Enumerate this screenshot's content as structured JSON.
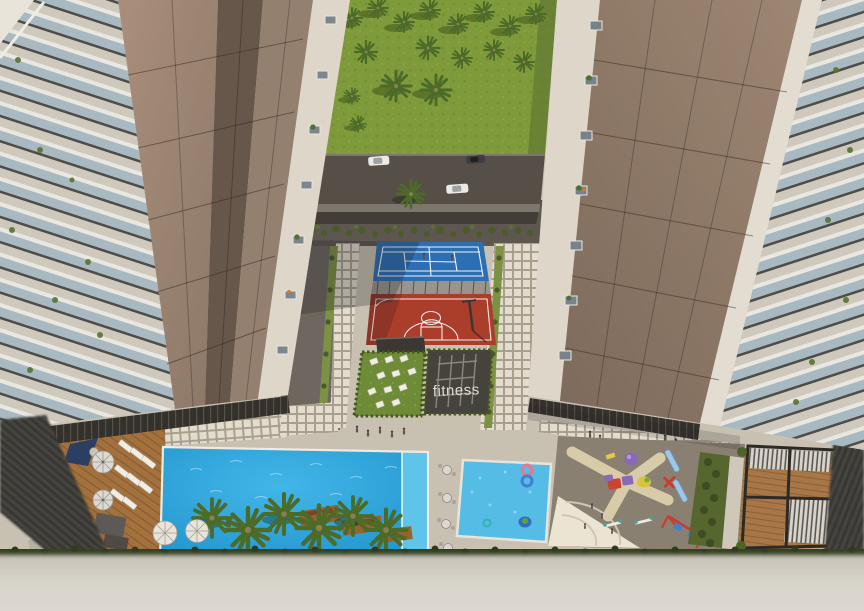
{
  "scene": {
    "type": "aerial-architectural-rendering",
    "description": "Bird's-eye view of twin residential towers around a landscaped courtyard",
    "ground_label": "fitness",
    "counts": {
      "cars": 3,
      "swing_frames": 2,
      "deck_umbrellas": 2,
      "pool_umbrellas": 2
    },
    "amenities": [
      "tennis court",
      "basketball court",
      "outdoor gym",
      "yoga lawn",
      "main swimming pool",
      "kids pool",
      "children playground",
      "pool deck with sun loungers",
      "pergola lounge",
      "palm park",
      "access road"
    ],
    "colors": {
      "paving": "#c8c0b1",
      "dark_paving": "#6e675f",
      "park_grass": "#7e9a3a",
      "road": "#564f48",
      "tennis_blue": "#2d6fb4",
      "basketball_red": "#ab3d2b",
      "fence_grey": "#9a958c",
      "fitness_lawn": "#6e8c38",
      "gym_floor": "#46433c",
      "court_line": "#ffffff",
      "main_pool": "#1f9fd8",
      "pool_ledge": "#62c6ea",
      "kids_pool": "#55bce6",
      "sand": "#ece4d2",
      "playground_ground": "#8a8071",
      "play_path": "#d8cca8",
      "hedge": "#4a5a2b",
      "facade_tan": "#a18a77",
      "facade_shadow": "#67564a",
      "facade_muted": "#94806f",
      "facade_light": "#ddd6c9",
      "glazing": "#35322e",
      "pergola_frame": "#2c2a27",
      "foreground": "#d7d3ca",
      "navy_sail": "#2b3f63",
      "car_white": "#eceae6",
      "car_dark": "#3d3d42"
    }
  }
}
